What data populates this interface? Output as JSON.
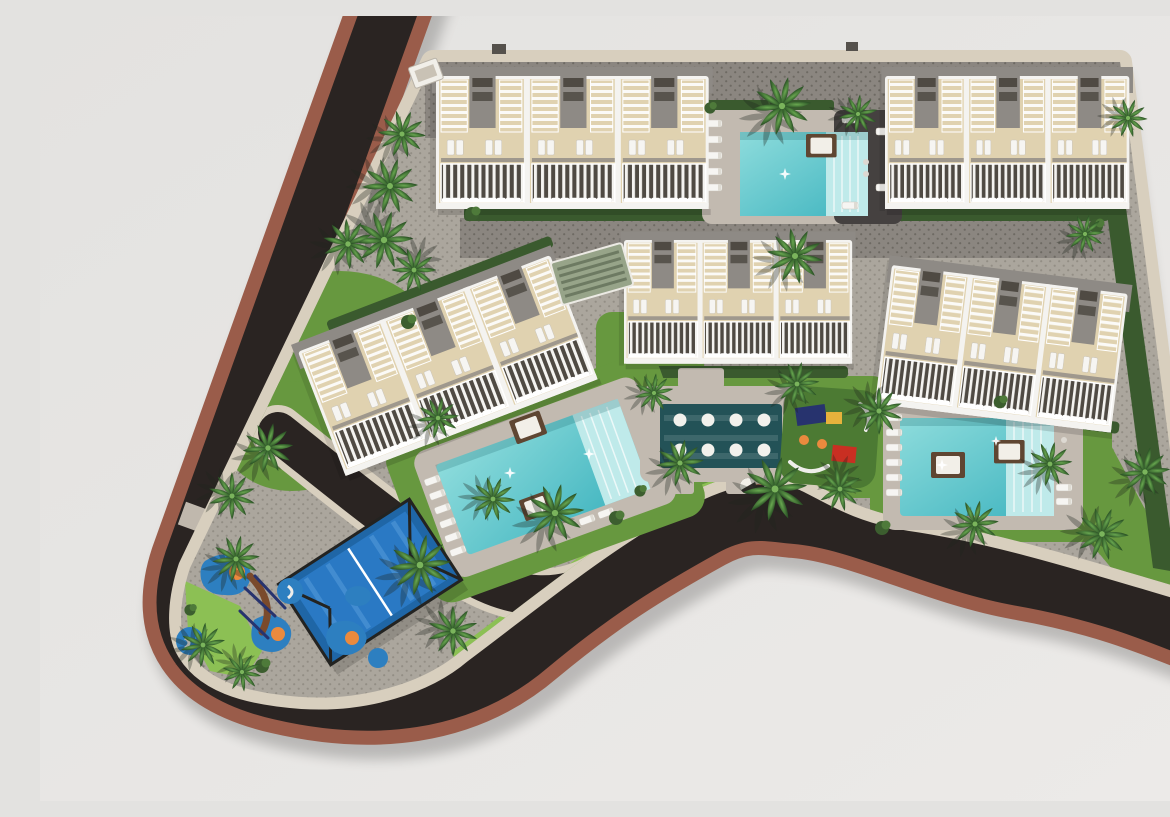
{
  "meta": {
    "title": "Aerial 3D site-plan render of a residential resort complex",
    "type": "architectural-visualization"
  },
  "colors": {
    "bg": "#e3e2e0",
    "bg-2": "#eceae8",
    "asphalt": "#2a2422",
    "terracotta": "#9a5c4a",
    "sidewalk": "#d8cfbe",
    "paving-light": "#aba69d",
    "dot-light": "#938e85",
    "paving-dark": "#8b8680",
    "dot-dark": "#6e6a63",
    "deck": "#c2bab0",
    "deck-dark": "#454140",
    "lawn": "#67983f",
    "lawn-bright": "#8cc054",
    "lawn-dark": "#4c7a33",
    "hedge": "#3a5a2e",
    "palm-hi": "#69a850",
    "palm-lo": "#2d5527",
    "pool-hi": "#8edcdc",
    "pool-lo": "#3fb4bf",
    "pool-steps": "#bfeaea",
    "spa": "#235257",
    "white": "#f4f3f0",
    "terrace": "#e0d2b0",
    "roof": "#8e8a85",
    "win": "#4f4a43",
    "court": "#2a79c4",
    "court-dark": "#1f66a6",
    "court-stripe": "#5aa0dc",
    "fence": "#232321",
    "splat": "#2d7fc0",
    "orange": "#ea8a3e",
    "red": "#c92f22",
    "navy": "#27336e",
    "yellow": "#e7b23c",
    "brown": "#7a4a2c",
    "cabana": "#5f4632"
  },
  "scene": {
    "site": {
      "label": "Gated residential development seen from above",
      "ground": "dot-grid paver plaza"
    },
    "roads": {
      "label": "Perimeter road",
      "description": "Dark asphalt road with terracotta edge bands wrapping the left side and curving along the bottom of the site"
    },
    "buildings": {
      "count": 5,
      "label": "Apartment blocks",
      "description": "White low-rise blocks with beige roof terraces, slatted pergolas, grey stair cores and balconies with white railings"
    },
    "pools": {
      "count": 3,
      "label": "Swimming pools",
      "description": "Turquoise community pools with shallow step ends, timber day beds and white sun loungers"
    },
    "spa": {
      "label": "Wellness pool",
      "loungers_in_water": 8
    },
    "padel_court": {
      "label": "Padel court",
      "surface": "blue",
      "fenced": true
    },
    "playgrounds": {
      "count": 2,
      "label": "Playgrounds",
      "description": "Blue rubber safety pads with orange rings and climbing frames; green rubber toddler area with colourful equipment"
    },
    "palm_trees": {
      "count": 30
    },
    "parking": {
      "label": "Access lanes / parking strips",
      "texture": "dark dotted paving"
    }
  }
}
